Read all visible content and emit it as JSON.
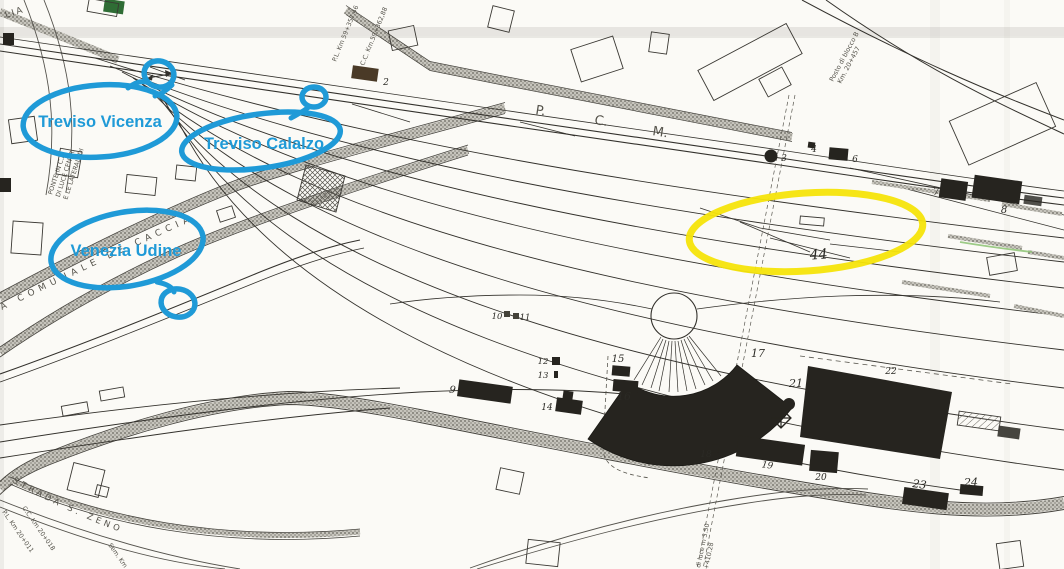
{
  "colors": {
    "paper": "#fbfaf6",
    "ink": "#33312c",
    "annotation_blue": "#1f9ad7",
    "highlight_yellow": "#f6e40a",
    "building_green": "#2f6d35",
    "building_brown": "#4a3a27",
    "track_green": "#8cc273",
    "building_dark": "#26241f"
  },
  "annotations": {
    "labels": [
      {
        "text": "Treviso Vicenza"
      },
      {
        "text": "Treviso Calalzo"
      },
      {
        "text": "Venezia Udine"
      }
    ],
    "yellow_highlight": "ellipse highlight on yard tracks"
  },
  "map_texts": {
    "lia": "LIA",
    "ponte1": "PONTE IN C.A.",
    "ponte2": "DI LUCE CENTR.",
    "ponte3": "E LE LATERALI DI",
    "km_pl59": "P.L. Km 59+357,46",
    "km_cc59": "C.C. Km.59+362,88",
    "pcm_p": "P.",
    "pcm_c": "C.",
    "pcm_m": "M.",
    "posto1": "Posto di blocco B",
    "posto2": "Km. 20+457",
    "caccia": "A COMUNALE DE CACCIA",
    "zeno": "STRADA S. ZENO",
    "km_cc20": "C.C. Km 20+018",
    "km_pl20": "P.L. Km 20+011",
    "sem": "Sem. Km",
    "luce1": "di luce m 3.50",
    "luce2": "+410.28"
  },
  "markers": [
    {
      "n": "2"
    },
    {
      "n": "3"
    },
    {
      "n": "4"
    },
    {
      "n": "6"
    },
    {
      "n": "7"
    },
    {
      "n": "8"
    },
    {
      "n": "9"
    },
    {
      "n": "10"
    },
    {
      "n": "11"
    },
    {
      "n": "12"
    },
    {
      "n": "13"
    },
    {
      "n": "14"
    },
    {
      "n": "15"
    },
    {
      "n": "16"
    },
    {
      "n": "17"
    },
    {
      "n": "18"
    },
    {
      "n": "19"
    },
    {
      "n": "20"
    },
    {
      "n": "21"
    },
    {
      "n": "22"
    },
    {
      "n": "23"
    },
    {
      "n": "24"
    },
    {
      "n": "44"
    }
  ]
}
